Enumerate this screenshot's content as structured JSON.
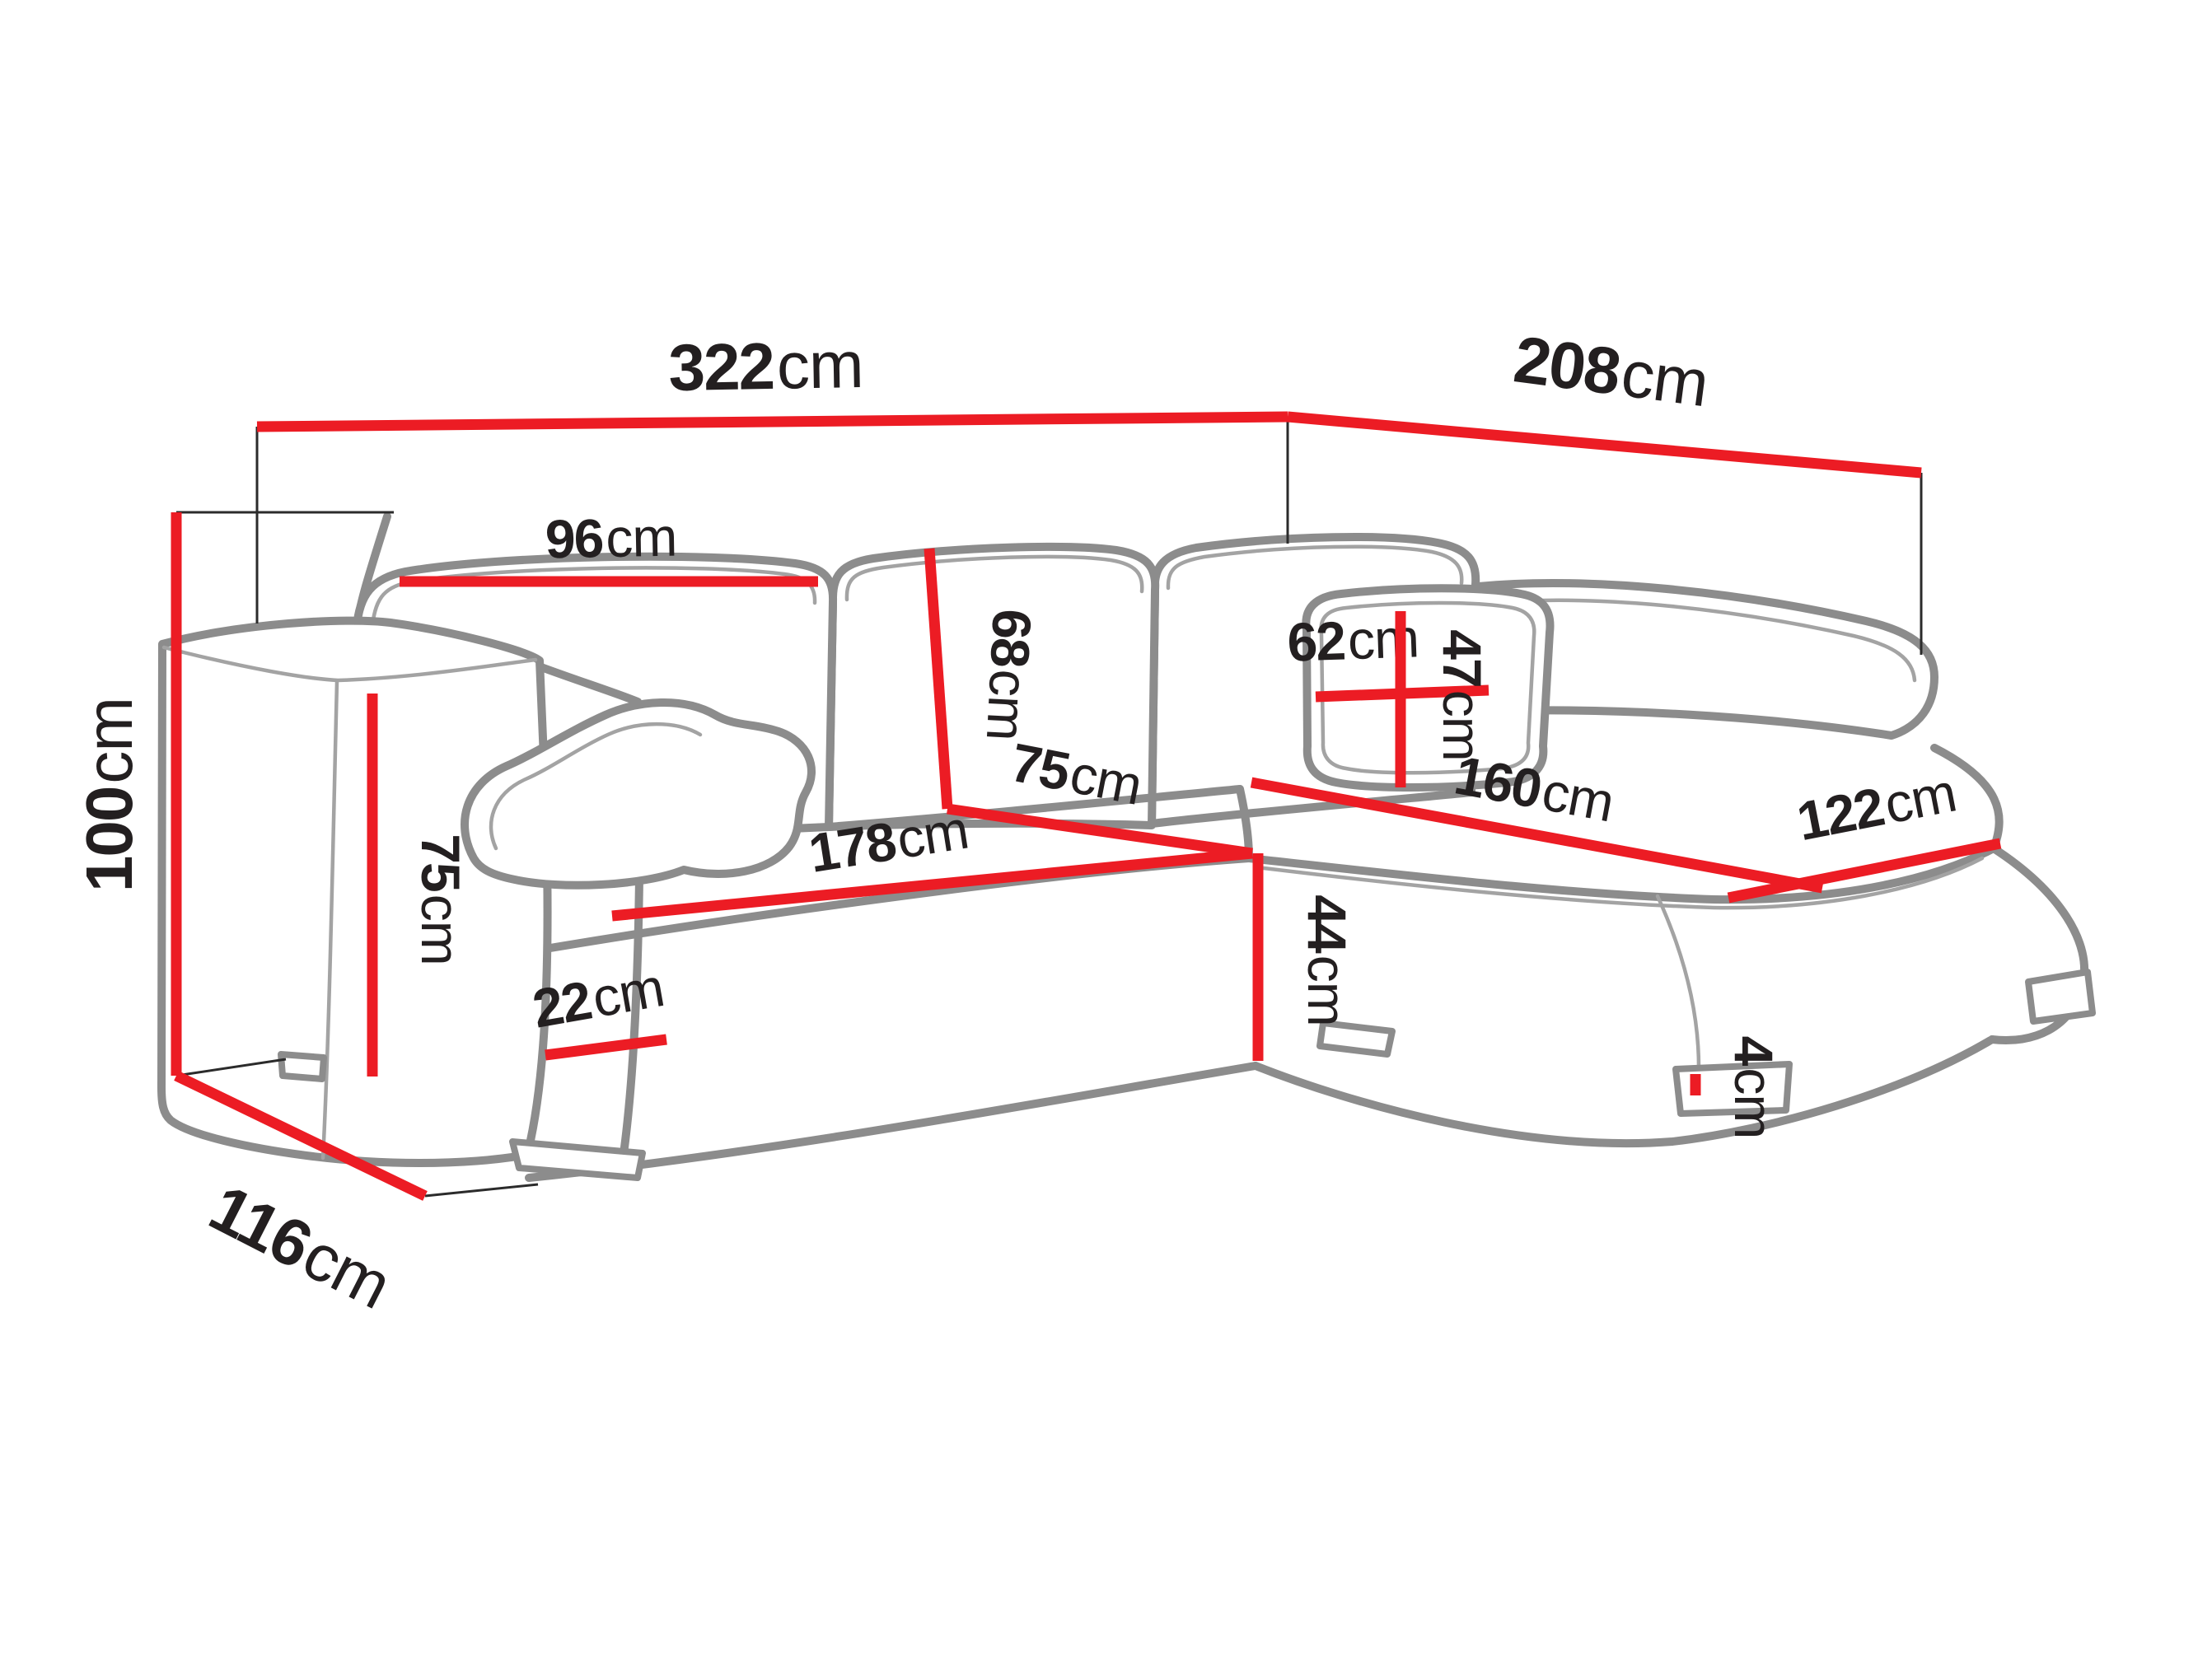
{
  "diagram": {
    "title": "corner-sofa-dimension-diagram",
    "subject": "corner sofa with chaise longue, sketch with dimension lines",
    "unit": "cm",
    "accent_color": "#ec1c24",
    "outline_color": "#8c8c8c",
    "text_color": "#231f20",
    "dimensions": {
      "total_width": {
        "value": "322",
        "unit": "cm",
        "description": "overall width along the back"
      },
      "total_depth": {
        "value": "208",
        "unit": "cm",
        "description": "overall depth along right side"
      },
      "total_height": {
        "value": "100",
        "unit": "cm",
        "description": "overall height"
      },
      "base_depth": {
        "value": "116",
        "unit": "cm",
        "description": "depth of sofa body at left side"
      },
      "back_cushion_width": {
        "value": "96",
        "unit": "cm",
        "description": "back cushion width"
      },
      "back_cushion_height": {
        "value": "68",
        "unit": "cm",
        "description": "back cushion height"
      },
      "seat_depth": {
        "value": "75",
        "unit": "cm",
        "description": "seat depth"
      },
      "seat_width": {
        "value": "178",
        "unit": "cm",
        "description": "seat width"
      },
      "seat_height": {
        "value": "44",
        "unit": "cm",
        "description": "seat height"
      },
      "armrest_height": {
        "value": "75",
        "unit": "cm",
        "description": "armrest height"
      },
      "armrest_width": {
        "value": "22",
        "unit": "cm",
        "description": "armrest width"
      },
      "pillow_width": {
        "value": "62",
        "unit": "cm",
        "description": "small pillow width"
      },
      "pillow_height": {
        "value": "47",
        "unit": "cm",
        "description": "small pillow height"
      },
      "chaise_length": {
        "value": "160",
        "unit": "cm",
        "description": "chaise seat length"
      },
      "chaise_width": {
        "value": "122",
        "unit": "cm",
        "description": "chaise seat width"
      },
      "leg_height": {
        "value": "4",
        "unit": "cm",
        "description": "leg height"
      }
    }
  }
}
